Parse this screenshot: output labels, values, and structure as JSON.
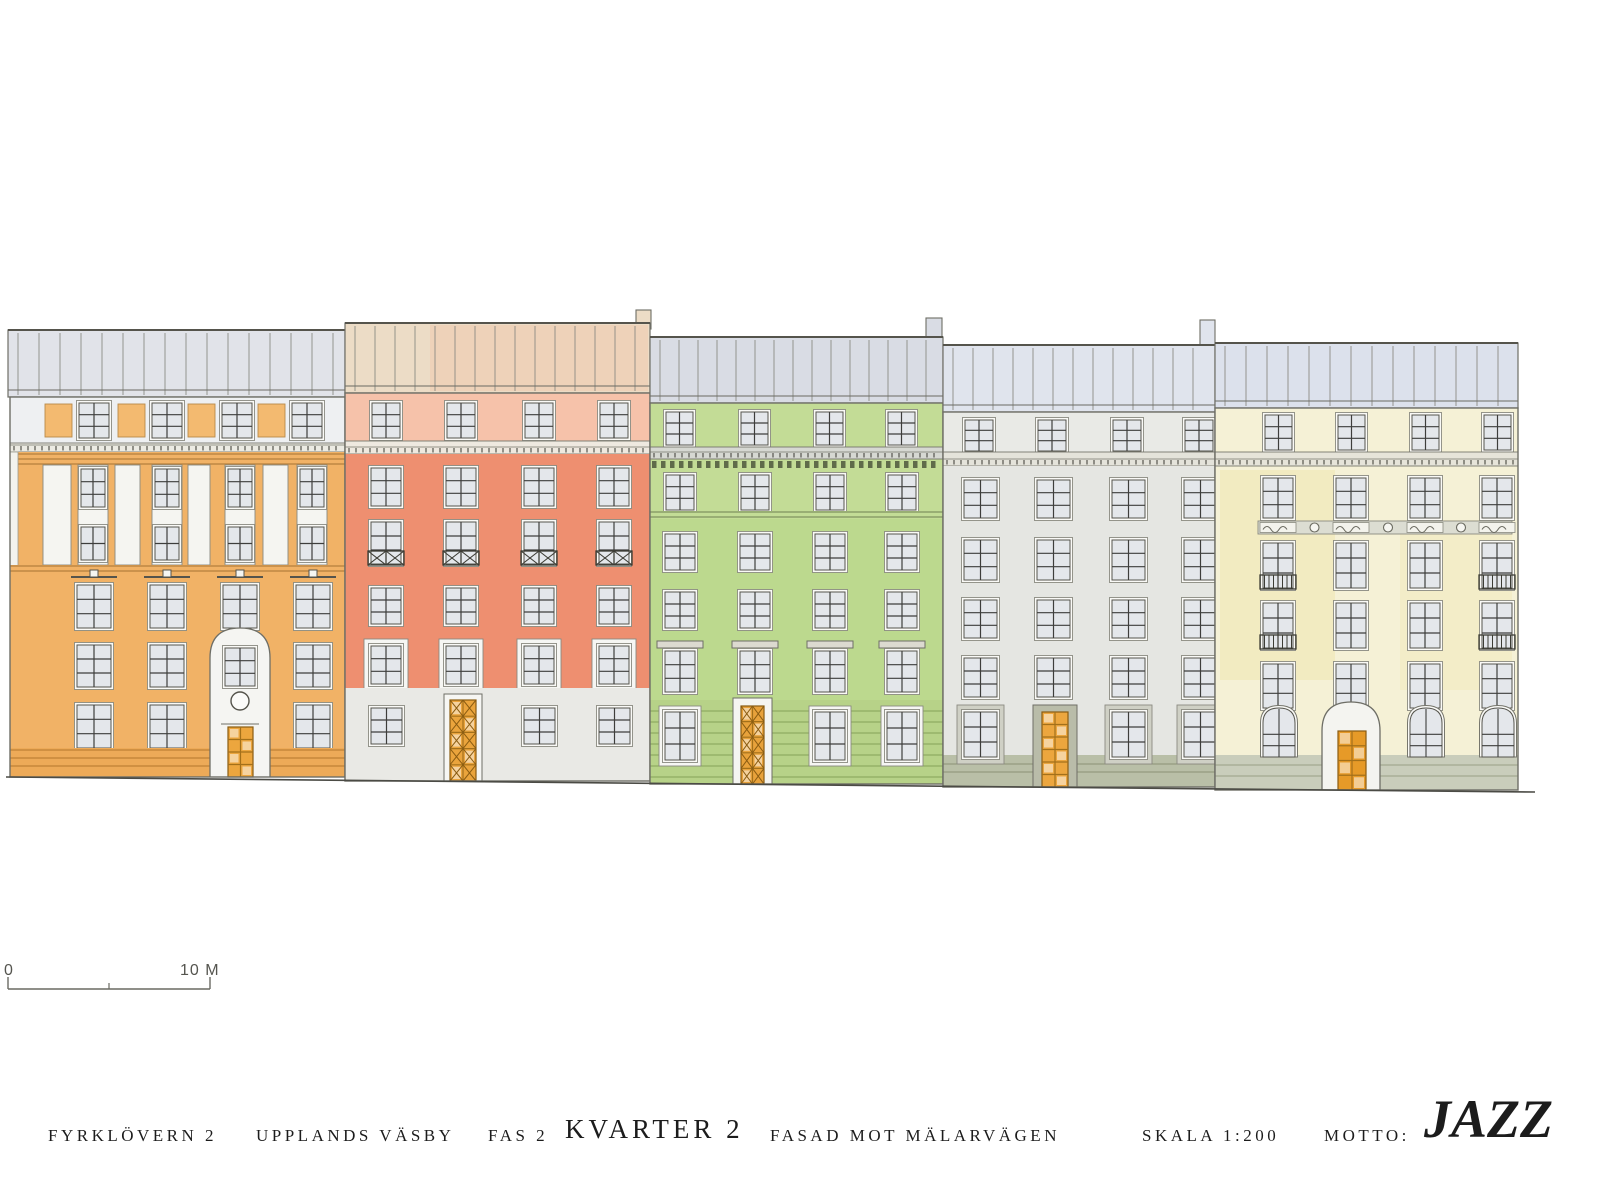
{
  "title_block": {
    "project": "FYRKLÖVERN 2",
    "location": "UPPLANDS VÄSBY",
    "phase": "FAS 2",
    "block": "KVARTER 2",
    "facade": "FASAD MOT MÄLARVÄGEN",
    "scale": "SKALA 1:200",
    "motto_label": "MOTTO:",
    "motto": "JAZZ"
  },
  "scale_bar": {
    "zero_label": "0",
    "end_label": "10 M",
    "x1": 8,
    "x2": 210,
    "y": 989,
    "mid": 109
  },
  "ground": {
    "x1": 6,
    "y1": 777,
    "x2": 1535,
    "y2": 792
  },
  "buildings": [
    {
      "name": "building-1-orange",
      "color_name": "orange",
      "facade_color": "#f1b266",
      "door_color": "#eca63e",
      "x": 10,
      "w": 335,
      "eave": 397,
      "bottom": 777,
      "ops": [
        {
          "t": "roof",
          "x": 8,
          "w": 337,
          "top": 330,
          "eave": 397,
          "f": "#e1e3e9",
          "seam": 21
        },
        {
          "t": "band",
          "x": 10,
          "w": 335,
          "y": 397,
          "h": 46,
          "f": "#eef0f2"
        },
        {
          "t": "blinds",
          "cols": [
            45,
            118,
            188,
            258
          ],
          "w": 27,
          "y": 404,
          "h": 33,
          "f": "#f3ba70"
        },
        {
          "t": "windows",
          "cols": [
            79,
            152,
            222,
            292
          ],
          "w": 30,
          "y": 403,
          "h": 35,
          "px": 2,
          "py": 3
        },
        {
          "t": "dentils",
          "x": 10,
          "w": 335,
          "y": 443,
          "h": 9,
          "f": "#ecebe3"
        },
        {
          "t": "band",
          "x": 10,
          "w": 335,
          "y": 452,
          "h": 13,
          "f": "#f1b266",
          "lines": [
            454,
            459,
            464
          ],
          "ls": "#b5803c",
          "lsw": 1.2
        },
        {
          "t": "rect",
          "x": 10,
          "y": 465,
          "w": 335,
          "h": 312,
          "f": "#f1b266"
        },
        {
          "t": "rect",
          "x": 10,
          "y": 452,
          "w": 8,
          "h": 116,
          "f": "#f3f3ee",
          "s": "#9a9a90",
          "sw": 0.8
        },
        {
          "t": "rects",
          "items": [
            [
              43,
              465,
              28,
              100
            ],
            [
              115,
              465,
              25,
              100
            ],
            [
              188,
              465,
              22,
              100
            ],
            [
              263,
              465,
              25,
              100
            ]
          ],
          "f": "#f5f5f1",
          "s": "#8a8a80",
          "sw": 0.9
        },
        {
          "t": "rects",
          "items": [
            [
              78,
              465,
              30,
              100
            ],
            [
              152,
              465,
              30,
              100
            ],
            [
              225,
              465,
              30,
              100
            ],
            [
              297,
              465,
              30,
              100
            ]
          ],
          "f": "#f5f5f1",
          "s": "#8a8a80",
          "sw": 0.9
        },
        {
          "t": "windows",
          "cols": [
            81,
            155,
            228,
            300
          ],
          "w": 24,
          "y": 469,
          "h": 38,
          "px": 2,
          "py": 3
        },
        {
          "t": "windows",
          "cols": [
            81,
            155,
            228,
            300
          ],
          "w": 24,
          "y": 527,
          "h": 33,
          "px": 2,
          "py": 2
        },
        {
          "t": "band",
          "x": 10,
          "w": 335,
          "y": 565,
          "h": 9,
          "f": "#f1b266",
          "lines": [
            566,
            571
          ],
          "ls": "#b5803c",
          "lsw": 1.2
        },
        {
          "t": "windows",
          "cols": [
            77,
            150,
            223,
            296
          ],
          "w": 34,
          "y": 585,
          "h": 43,
          "px": 2,
          "py": 3,
          "cap": "pediment"
        },
        {
          "t": "windows",
          "cols": [
            77,
            150,
            296
          ],
          "w": 34,
          "y": 645,
          "h": 42,
          "px": 2,
          "py": 3
        },
        {
          "t": "windows",
          "cols": [
            77,
            150,
            296
          ],
          "w": 34,
          "y": 705,
          "h": 43,
          "px": 2,
          "py": 3
        },
        {
          "t": "band",
          "x": 10,
          "w": 335,
          "y": 748,
          "h": 29,
          "f": "#edaa58",
          "lines": [
            750,
            758,
            766
          ],
          "ls": "#bf8034",
          "lsw": 1.3
        },
        {
          "t": "archstrip",
          "x": 210,
          "w": 60,
          "apex": 628,
          "r": 30,
          "bottom": 777,
          "f": "#f5f5f2"
        },
        {
          "t": "windows",
          "cols": [
            225
          ],
          "w": 30,
          "y": 648,
          "h": 38,
          "px": 2,
          "py": 3
        },
        {
          "t": "circle",
          "cx": 240,
          "cy": 701,
          "r": 9,
          "f": "#fbfbf9",
          "s": "#55544c",
          "sw": 1.4
        },
        {
          "t": "line",
          "x1": 221,
          "y1": 724,
          "x2": 259,
          "y2": 724,
          "s": "#6e6e66",
          "sw": 1
        },
        {
          "t": "door",
          "x": 228,
          "y": 727,
          "w": 25,
          "h": 50,
          "f": "#eca63e",
          "grid": [
            2,
            4
          ]
        }
      ]
    },
    {
      "name": "building-2-red",
      "color_name": "salmon-red",
      "facade_color": "#ee8f70",
      "door_color": "#eaa43c",
      "x": 345,
      "w": 305,
      "eave": 393,
      "bottom": 781,
      "ops": [
        {
          "t": "roof",
          "x": 345,
          "w": 305,
          "top": 323,
          "eave": 393,
          "f": "#ecdcc6",
          "seam": 20,
          "tints": [
            {
              "x": 430,
              "w": 218,
              "f": "#f3c0a0",
              "o": 0.35
            }
          ],
          "chimneys": [
            {
              "x": 636,
              "w": 15,
              "top": 310
            }
          ]
        },
        {
          "t": "band",
          "x": 345,
          "w": 305,
          "y": 393,
          "h": 48,
          "f": "#f6c2aa"
        },
        {
          "t": "windows",
          "cols": [
            372,
            447,
            525,
            600
          ],
          "w": 28,
          "y": 403,
          "h": 35,
          "px": 2,
          "py": 3
        },
        {
          "t": "dentils",
          "x": 345,
          "w": 305,
          "y": 441,
          "h": 13,
          "f": "#efe9e0"
        },
        {
          "t": "rect",
          "x": 345,
          "y": 454,
          "w": 305,
          "h": 234,
          "f": "#ee8f70"
        },
        {
          "t": "windows",
          "cols": [
            371,
            446,
            524,
            599
          ],
          "w": 30,
          "y": 468,
          "h": 38,
          "px": 2,
          "py": 3
        },
        {
          "t": "windows",
          "cols": [
            371,
            446,
            524,
            599
          ],
          "w": 30,
          "y": 522,
          "h": 42,
          "px": 2,
          "py": 3,
          "railing": "x"
        },
        {
          "t": "windows",
          "cols": [
            371,
            446,
            524,
            599
          ],
          "w": 30,
          "y": 588,
          "h": 36,
          "px": 2,
          "py": 3
        },
        {
          "t": "windows",
          "cols": [
            371,
            446,
            524,
            599
          ],
          "w": 30,
          "y": 646,
          "h": 38,
          "px": 2,
          "py": 3,
          "surround": 5
        },
        {
          "t": "band",
          "x": 345,
          "w": 305,
          "y": 688,
          "h": 93,
          "f": "#e9e9e5"
        },
        {
          "t": "windows",
          "cols": [
            371,
            524,
            599
          ],
          "w": 31,
          "y": 708,
          "h": 36,
          "px": 2,
          "py": 3
        },
        {
          "t": "door",
          "x": 450,
          "y": 700,
          "w": 26,
          "h": 81,
          "f": "#eaa43c",
          "grid": [
            2,
            5
          ],
          "style": "x",
          "frame": {
            "pad": 6,
            "f": "#f6f6f3"
          }
        }
      ]
    },
    {
      "name": "building-3-green",
      "color_name": "green",
      "facade_color": "#bcd98e",
      "door_color": "#e8a23b",
      "x": 650,
      "w": 293,
      "eave": 403,
      "bottom": 784,
      "ops": [
        {
          "t": "roof",
          "x": 650,
          "w": 293,
          "top": 337,
          "eave": 403,
          "f": "#d9dce4",
          "seam": 19,
          "chimneys": [
            {
              "x": 926,
              "w": 16,
              "top": 318
            }
          ]
        },
        {
          "t": "band",
          "x": 650,
          "w": 293,
          "y": 403,
          "h": 115,
          "f": "#c3dc96"
        },
        {
          "t": "windows",
          "cols": [
            666,
            741,
            816,
            888
          ],
          "w": 27,
          "y": 412,
          "h": 33,
          "px": 2,
          "py": 3
        },
        {
          "t": "dentils",
          "x": 650,
          "w": 293,
          "y": 447,
          "h": 12,
          "f": "#d6d8d2"
        },
        {
          "t": "checker",
          "x": 652,
          "w": 289,
          "y": 461,
          "h": 7,
          "f": "#5f6b4a",
          "step": 9
        },
        {
          "t": "windows",
          "cols": [
            666,
            741,
            816,
            888
          ],
          "w": 28,
          "y": 475,
          "h": 35,
          "px": 2,
          "py": 3
        },
        {
          "t": "band",
          "x": 650,
          "w": 293,
          "y": 511,
          "h": 8,
          "f": "#c3dc96",
          "lines": [
            512,
            517
          ],
          "ls": "#6f7f52",
          "lsw": 1
        },
        {
          "t": "rect",
          "x": 650,
          "y": 519,
          "w": 293,
          "h": 181,
          "f": "#bcd98e"
        },
        {
          "t": "windows",
          "cols": [
            665,
            740,
            815,
            887
          ],
          "w": 30,
          "y": 534,
          "h": 36,
          "px": 2,
          "py": 3
        },
        {
          "t": "windows",
          "cols": [
            665,
            740,
            815,
            887
          ],
          "w": 30,
          "y": 592,
          "h": 36,
          "px": 2,
          "py": 3
        },
        {
          "t": "windows",
          "cols": [
            665,
            740,
            815,
            887
          ],
          "w": 30,
          "y": 651,
          "h": 41,
          "px": 2,
          "py": 3,
          "cap": "hood"
        },
        {
          "t": "band",
          "x": 650,
          "w": 293,
          "y": 700,
          "h": 84,
          "f": "#b7d288"
        },
        {
          "t": "hlines",
          "x": 650,
          "w": 293,
          "ys": [
            711,
            722,
            733,
            744,
            755,
            766,
            777
          ],
          "s": "#85a259",
          "sw": 1
        },
        {
          "t": "windows",
          "cols": [
            665,
            815,
            887
          ],
          "w": 30,
          "y": 712,
          "h": 48,
          "px": 2,
          "py": 3,
          "surround": 4
        },
        {
          "t": "door",
          "x": 741,
          "y": 706,
          "w": 23,
          "h": 78,
          "f": "#e8a23b",
          "grid": [
            2,
            5
          ],
          "style": "x",
          "frame": {
            "pad": 8,
            "f": "#f5f5f1"
          }
        }
      ]
    },
    {
      "name": "building-4-grey",
      "color_name": "light-grey",
      "facade_color": "#e5e6e2",
      "door_color": "#eca63e",
      "x": 943,
      "w": 272,
      "eave": 412,
      "bottom": 787,
      "ops": [
        {
          "t": "roof",
          "x": 943,
          "w": 272,
          "top": 345,
          "eave": 412,
          "f": "#e0e4ed",
          "seam": 20,
          "chimneys": [
            {
              "x": 1200,
              "w": 15,
              "top": 320
            }
          ]
        },
        {
          "t": "band",
          "x": 943,
          "w": 272,
          "y": 412,
          "h": 40,
          "f": "#e9eae6"
        },
        {
          "t": "windows",
          "cols": [
            965,
            1038,
            1113,
            1185
          ],
          "w": 28,
          "y": 420,
          "h": 31,
          "px": 2,
          "py": 3
        },
        {
          "t": "dentils",
          "x": 943,
          "w": 272,
          "y": 452,
          "h": 14,
          "f": "#e4e3da"
        },
        {
          "t": "rect",
          "x": 943,
          "y": 466,
          "w": 272,
          "h": 321,
          "f": "#e5e6e2"
        },
        {
          "t": "windows",
          "cols": [
            964,
            1037,
            1112,
            1184
          ],
          "w": 33,
          "y": 480,
          "h": 38,
          "px": 2,
          "py": 3
        },
        {
          "t": "windows",
          "cols": [
            964,
            1037,
            1112,
            1184
          ],
          "w": 33,
          "y": 540,
          "h": 40,
          "px": 2,
          "py": 3
        },
        {
          "t": "windows",
          "cols": [
            964,
            1037,
            1112,
            1184
          ],
          "w": 33,
          "y": 600,
          "h": 38,
          "px": 2,
          "py": 3
        },
        {
          "t": "windows",
          "cols": [
            964,
            1037,
            1112,
            1184
          ],
          "w": 33,
          "y": 658,
          "h": 39,
          "px": 2,
          "py": 3
        },
        {
          "t": "band",
          "x": 943,
          "w": 272,
          "y": 755,
          "h": 32,
          "f": "#b9bfa7",
          "lines": [
            764,
            772
          ],
          "ls": "#8b9274",
          "lsw": 1.1
        },
        {
          "t": "windows",
          "cols": [
            964,
            1112,
            1184
          ],
          "w": 33,
          "y": 712,
          "h": 45,
          "px": 2,
          "py": 3,
          "surround": 5,
          "sc": "#cfd0c5"
        },
        {
          "t": "rect",
          "x": 1033,
          "y": 705,
          "w": 44,
          "h": 82,
          "f": "#b9bca9",
          "s": "#6e6e66",
          "sw": 1
        },
        {
          "t": "door",
          "x": 1042,
          "y": 712,
          "w": 26,
          "h": 75,
          "f": "#eca63e",
          "grid": [
            2,
            6
          ]
        }
      ]
    },
    {
      "name": "building-5-yellow",
      "color_name": "pale-yellow",
      "facade_color": "#f5f1d6",
      "door_color": "#e69a28",
      "x": 1215,
      "w": 303,
      "eave": 408,
      "bottom": 790,
      "ops": [
        {
          "t": "roof",
          "x": 1215,
          "w": 303,
          "top": 343,
          "eave": 408,
          "f": "#dce1ec",
          "seam": 21
        },
        {
          "t": "rect",
          "x": 1215,
          "y": 408,
          "w": 303,
          "h": 382,
          "f": "#f5f1d6"
        },
        {
          "t": "rect",
          "x": 1220,
          "y": 470,
          "w": 115,
          "h": 210,
          "f": "#f0e5a8",
          "o": 0.45
        },
        {
          "t": "rect",
          "x": 1400,
          "y": 520,
          "w": 112,
          "h": 170,
          "f": "#f0e5a8",
          "o": 0.3
        },
        {
          "t": "windows",
          "cols": [
            1265,
            1338,
            1412,
            1484
          ],
          "w": 27,
          "y": 415,
          "h": 35,
          "px": 2,
          "py": 3
        },
        {
          "t": "dentils",
          "x": 1215,
          "w": 303,
          "y": 452,
          "h": 14,
          "f": "#e6e4d9"
        },
        {
          "t": "windows",
          "cols": [
            1263,
            1336,
            1410,
            1482
          ],
          "w": 30,
          "y": 478,
          "h": 40,
          "px": 2,
          "py": 3
        },
        {
          "t": "frieze",
          "x": 1258,
          "w": 254,
          "y": 521,
          "h": 13,
          "f": "#dcddd2",
          "cols": [
            1263,
            1336,
            1410,
            1482
          ],
          "cw": 30
        },
        {
          "t": "windows",
          "cols": [
            1263,
            1336,
            1410,
            1482
          ],
          "w": 30,
          "y": 543,
          "h": 45,
          "px": 2,
          "py": 3,
          "railing": "bars",
          "railCols": [
            0,
            3
          ]
        },
        {
          "t": "windows",
          "cols": [
            1263,
            1336,
            1410,
            1482
          ],
          "w": 30,
          "y": 603,
          "h": 45,
          "px": 2,
          "py": 3,
          "railing": "bars",
          "railCols": [
            0,
            3
          ]
        },
        {
          "t": "windows",
          "cols": [
            1263,
            1336,
            1410,
            1482
          ],
          "w": 30,
          "y": 664,
          "h": 44,
          "px": 2,
          "py": 3
        },
        {
          "t": "band",
          "x": 1215,
          "w": 303,
          "y": 755,
          "h": 35,
          "f": "#c9cdbb",
          "lines": [
            765,
            776
          ],
          "ls": "#99a085",
          "lsw": 1.1
        },
        {
          "t": "windows",
          "cols": [
            1263,
            1410,
            1482
          ],
          "w": 32,
          "y": 708,
          "h": 49,
          "px": 2,
          "py": 3,
          "arch": 15
        },
        {
          "t": "archstrip",
          "x": 1322,
          "w": 58,
          "apex": 702,
          "r": 29,
          "bottom": 790,
          "f": "#f4f4f0"
        },
        {
          "t": "door",
          "x": 1338,
          "y": 731,
          "w": 28,
          "h": 59,
          "f": "#e69a28",
          "grid": [
            2,
            4
          ]
        }
      ]
    }
  ]
}
